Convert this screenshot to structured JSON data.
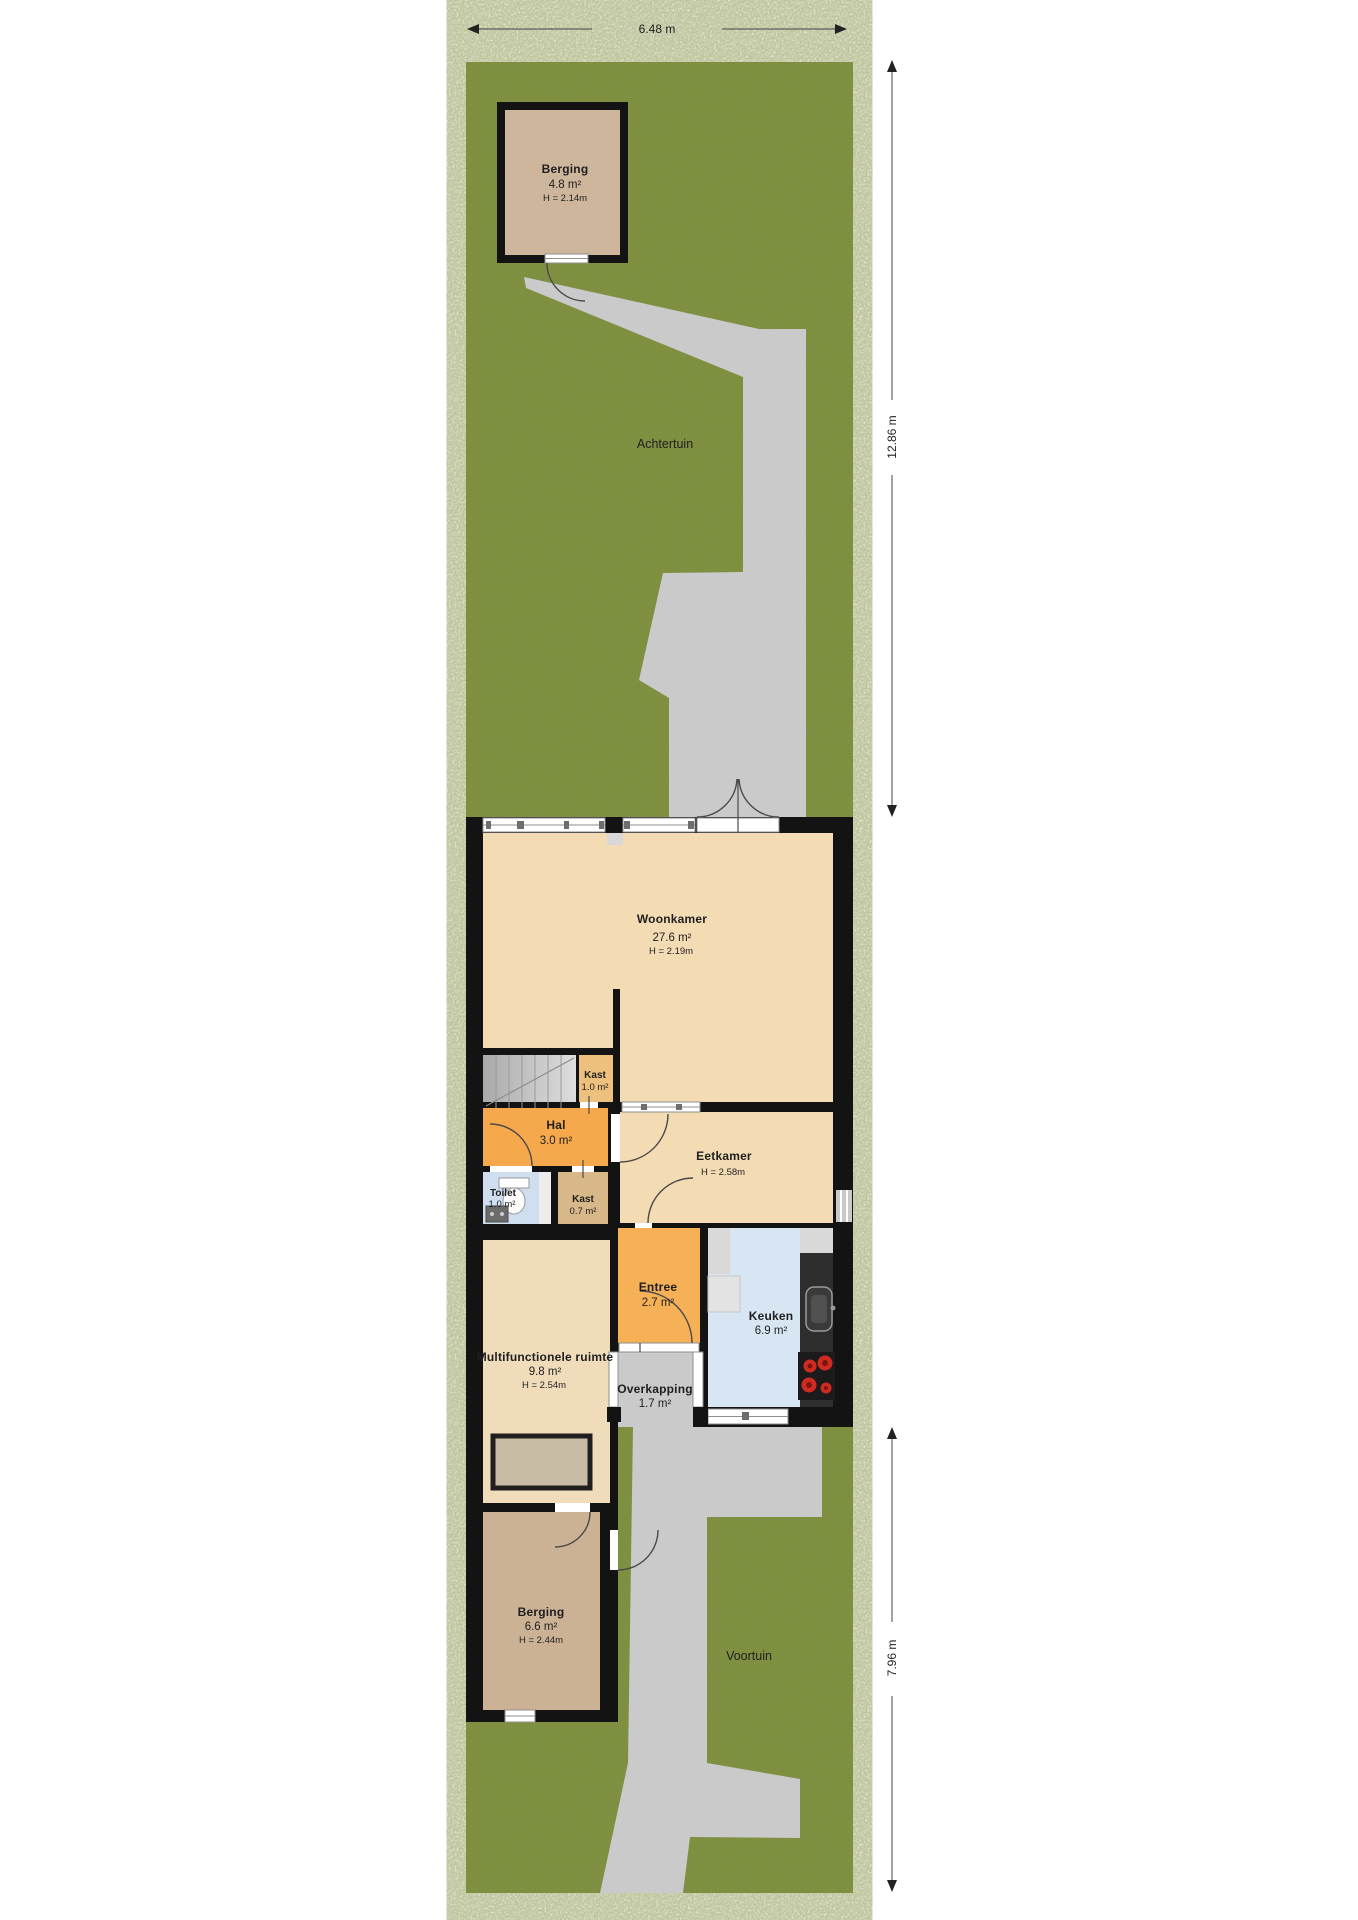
{
  "plan_title": "Begane grond met tuin",
  "dimensions": {
    "width_top": "6.48 m",
    "back_garden_depth": "12.86 m",
    "front_garden_depth": "7.96 m"
  },
  "garden": {
    "back_label": "Achtertuin",
    "front_label": "Voortuin"
  },
  "rooms": [
    {
      "id": "berging-achtertuin",
      "name": "Berging",
      "area": "4.8 m²",
      "height": "H = 2.14m"
    },
    {
      "id": "woonkamer",
      "name": "Woonkamer",
      "area": "27.6 m²",
      "height": "H = 2.19m"
    },
    {
      "id": "kast-boven",
      "name": "Kast",
      "area": "1.0 m²",
      "height": ""
    },
    {
      "id": "hal",
      "name": "Hal",
      "area": "3.0 m²",
      "height": ""
    },
    {
      "id": "toilet",
      "name": "Toilet",
      "area": "1.0 m²",
      "height": ""
    },
    {
      "id": "kast-klein",
      "name": "Kast",
      "area": "0.7 m²",
      "height": ""
    },
    {
      "id": "eetkamer",
      "name": "Eetkamer",
      "area": "",
      "height": "H = 2.58m"
    },
    {
      "id": "entree",
      "name": "Entree",
      "area": "2.7 m²",
      "height": ""
    },
    {
      "id": "keuken",
      "name": "Keuken",
      "area": "6.9 m²",
      "height": ""
    },
    {
      "id": "multifunctionele-ruimte",
      "name": "Multifunctionele ruimte",
      "area": "9.8 m²",
      "height": "H = 2.54m"
    },
    {
      "id": "overkapping",
      "name": "Overkapping",
      "area": "1.7 m²",
      "height": ""
    },
    {
      "id": "berging-voortuin",
      "name": "Berging",
      "area": "6.6 m²",
      "height": "H = 2.44m"
    }
  ],
  "colors": {
    "grass": "#7d9143",
    "path": "#cacaca",
    "wall": "#131313",
    "floor_beige": "#f3dcb4",
    "floor_multi": "#f0dcba",
    "hal_orange": "#f6a94c",
    "entree_orange": "#f6b157",
    "kast_orange": "#edc07d",
    "kast_tan": "#d8b788",
    "toilet_blue": "#cfdfef",
    "keuken_blue": "#d8e6f3",
    "berging_top_tan": "#cdb69c",
    "berging_bottom_tan": "#cbb294",
    "stair_gray": "#c2c2c2",
    "counter_dark": "#2e2e2e",
    "burner_red": "#cf2b20",
    "object_fill": "#c9bca5"
  }
}
